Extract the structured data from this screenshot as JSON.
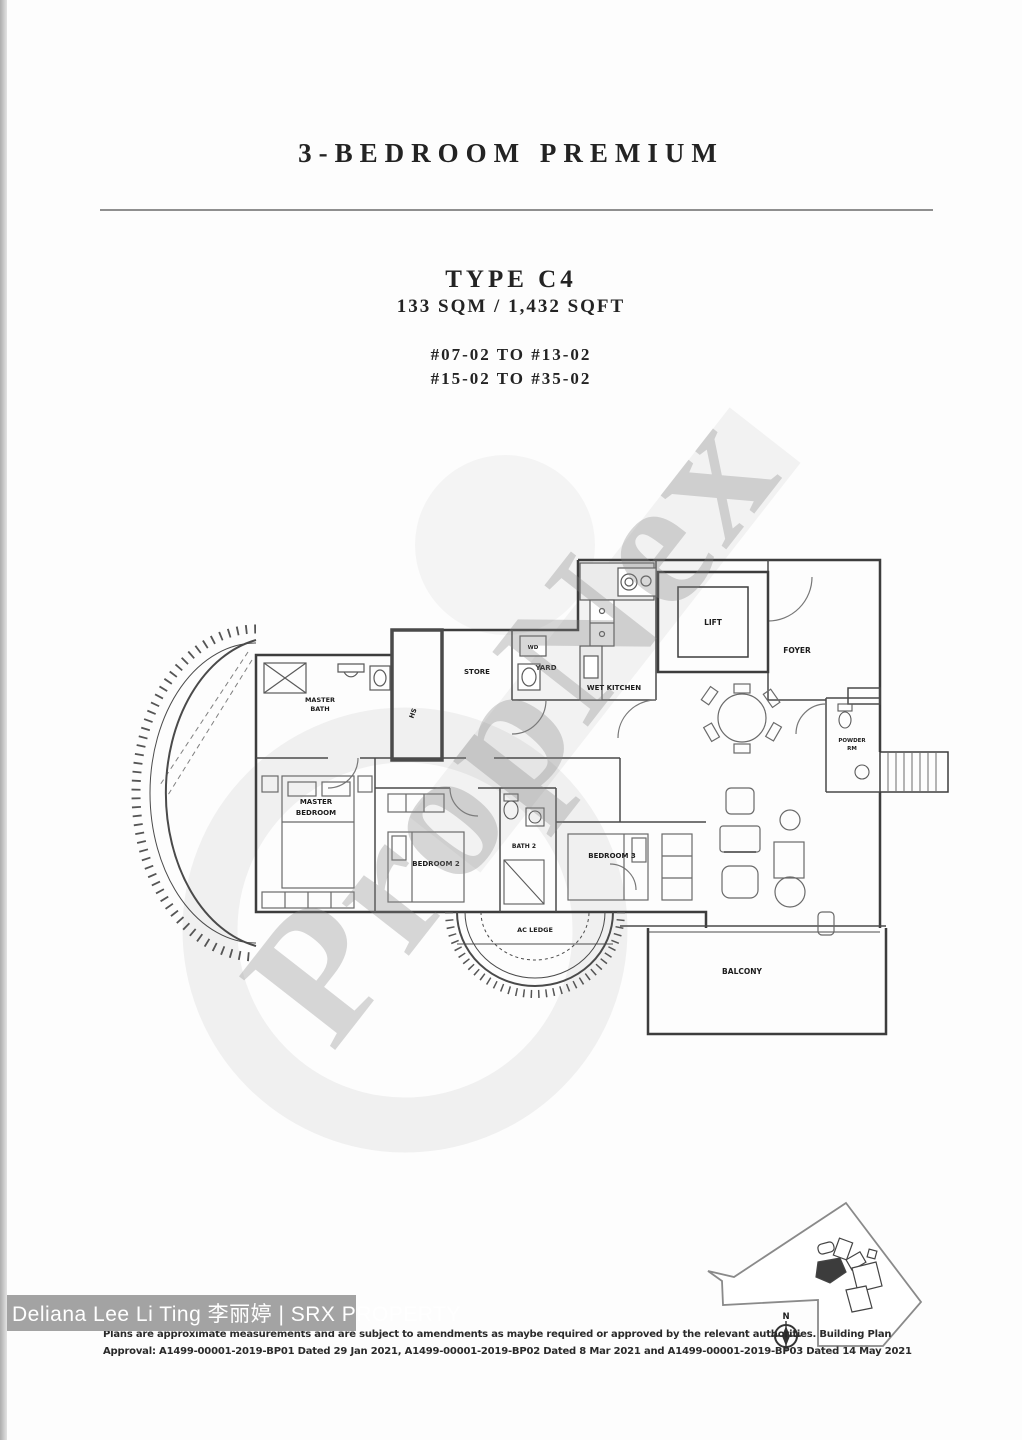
{
  "header": {
    "plan_name": "3-BEDROOM PREMIUM",
    "unit_type": "TYPE C4",
    "unit_area": "133 SQM / 1,432 SQFT",
    "stack_range_1": "#07-02 TO #13-02",
    "stack_range_2": "#15-02 TO #35-02"
  },
  "watermark": {
    "text": "PropNex"
  },
  "plan_labels": {
    "store": "STORE",
    "yard": "YARD",
    "washer_dryer": "WD",
    "wet_kitchen": "WET KITCHEN",
    "lift": "LIFT",
    "foyer": "FOYER",
    "master_bath_line1": "MASTER",
    "master_bath_line2": "BATH",
    "household_shelter": "HS",
    "master_bedroom_line1": "MASTER",
    "master_bedroom_line2": "BEDROOM",
    "bedroom_2": "BEDROOM 2",
    "bath_2": "BATH 2",
    "bedroom_3": "BEDROOM 3",
    "powder_room_line1": "POWDER",
    "powder_room_line2": "RM",
    "ac_ledge": "AC LEDGE",
    "balcony": "BALCONY"
  },
  "site_map": {
    "north_label": "N"
  },
  "footer": {
    "agent_credit": "Deliana Lee Li Ting 李丽婷 | SRX PROPERTY",
    "disclaimer_line_1": "Plans are approximate measurements and are subject to amendments as maybe required or approved by the relevant authorities. Building Plan",
    "disclaimer_line_2": "Approval: A1499-00001-2019-BP01 Dated 29 Jan 2021, A1499-00001-2019-BP02 Dated 8 Mar 2021 and A1499-00001-2019-BP03 Dated 14 May 2021"
  }
}
